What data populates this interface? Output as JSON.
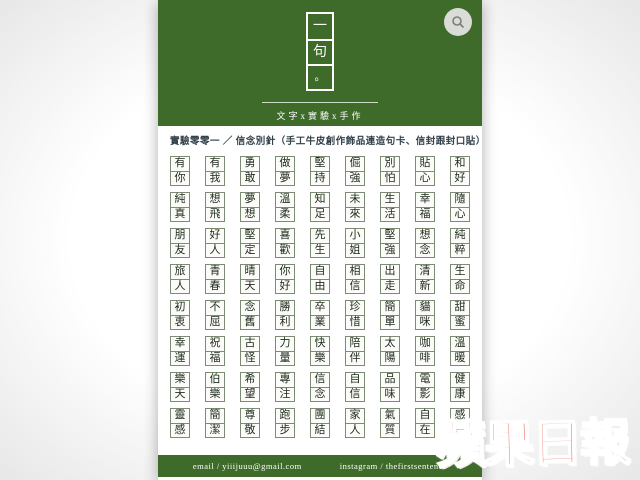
{
  "colors": {
    "brand_green": "#3e6b29",
    "watermark_red": "#e8382f"
  },
  "header": {
    "logo_chars": [
      "一",
      "句",
      "。"
    ],
    "tagline": "文字x實驗x手作"
  },
  "main": {
    "title": "實驗零零一 ／ 信念別針（手工牛皮創作飾品連造句卡、信封跟封口貼）",
    "badges": [
      "有你",
      "有我",
      "勇敢",
      "做夢",
      "堅持",
      "倔強",
      "別怕",
      "貼心",
      "和好",
      "純真",
      "想飛",
      "夢想",
      "溫柔",
      "知足",
      "未來",
      "生活",
      "幸福",
      "隨心",
      "朋友",
      "好人",
      "堅定",
      "喜歡",
      "先生",
      "小姐",
      "堅強",
      "想念",
      "純粹",
      "旅人",
      "青春",
      "晴天",
      "你好",
      "自由",
      "相信",
      "出走",
      "清新",
      "生命",
      "初衷",
      "不屈",
      "念舊",
      "勝利",
      "卒業",
      "珍惜",
      "簡單",
      "貓咪",
      "甜蜜",
      "幸運",
      "祝福",
      "古怪",
      "力量",
      "快樂",
      "陪伴",
      "太陽",
      "咖啡",
      "溫暖",
      "樂天",
      "伯樂",
      "希望",
      "專注",
      "信念",
      "自信",
      "品味",
      "電影",
      "健康",
      "靈感",
      "簡潔",
      "尊敬",
      "跑步",
      "團結",
      "家人",
      "氣質",
      "自在",
      "感恩"
    ]
  },
  "footer": {
    "email": "email / yiiijuuu@gmail.com",
    "instagram": "instagram / thefirstsentence"
  },
  "watermark": "蘋果日報"
}
